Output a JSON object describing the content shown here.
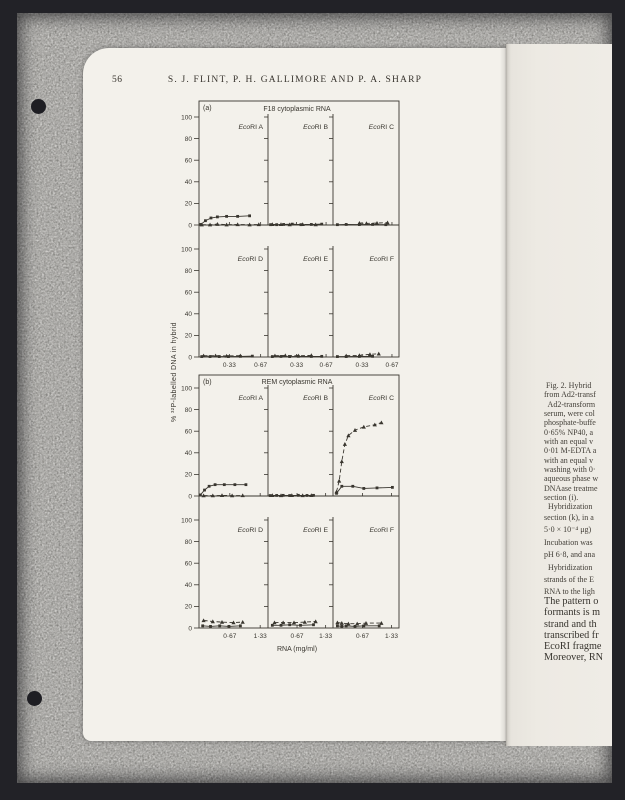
{
  "page": {
    "number": "56",
    "running_header": "S. J. FLINT, P. H. GALLIMORE AND P. A. SHARP"
  },
  "chart_data": {
    "type": "line",
    "ylabel": "% ³²P-labelled DNA in hybrid",
    "xlabel": "RNA (mg/ml)",
    "ylim": [
      0,
      100
    ],
    "y_ticks": [
      0,
      20,
      40,
      60,
      80,
      100
    ],
    "panels": [
      {
        "label": "(a)",
        "title": "F18 cytoplasmic RNA",
        "x_max": 0.75,
        "x_tick_values": [
          0.33,
          0.67
        ],
        "x_tick_labels": [
          "0·33",
          "0·67"
        ],
        "subpanels": [
          {
            "name": "EcoRI A",
            "solid": [
              [
                0.02,
                0.5
              ],
              [
                0.07,
                4
              ],
              [
                0.13,
                6.5
              ],
              [
                0.2,
                7.5
              ],
              [
                0.3,
                8
              ],
              [
                0.42,
                8
              ],
              [
                0.55,
                8.5
              ]
            ],
            "dashed": [
              [
                0.03,
                0.3
              ],
              [
                0.12,
                0.3
              ],
              [
                0.2,
                0.8
              ],
              [
                0.3,
                0.3
              ],
              [
                0.42,
                0.5
              ],
              [
                0.55,
                0.3
              ],
              [
                0.65,
                0.5
              ]
            ]
          },
          {
            "name": "EcoRI B",
            "solid": [
              [
                0.03,
                0.3
              ],
              [
                0.1,
                0.3
              ],
              [
                0.18,
                0.5
              ],
              [
                0.28,
                0.8
              ],
              [
                0.38,
                0.3
              ],
              [
                0.5,
                0.5
              ],
              [
                0.62,
                0.8
              ]
            ],
            "dashed": [
              [
                0.05,
                0.6
              ],
              [
                0.15,
                0.6
              ],
              [
                0.25,
                0.4
              ],
              [
                0.4,
                0.6
              ],
              [
                0.55,
                0.4
              ]
            ]
          },
          {
            "name": "EcoRI C",
            "solid": [
              [
                0.05,
                0.3
              ],
              [
                0.15,
                0.5
              ],
              [
                0.3,
                0.4
              ],
              [
                0.45,
                0.5
              ],
              [
                0.6,
                0.3
              ]
            ],
            "dashed": [
              [
                0.3,
                1.8
              ],
              [
                0.38,
                1.5
              ],
              [
                0.5,
                1.8
              ],
              [
                0.62,
                2.2
              ]
            ]
          },
          {
            "name": "EcoRI D",
            "solid": [
              [
                0.03,
                0.4
              ],
              [
                0.12,
                0.4
              ],
              [
                0.22,
                0.4
              ],
              [
                0.32,
                0.4
              ],
              [
                0.45,
                0.6
              ],
              [
                0.58,
                0.8
              ]
            ],
            "dashed": [
              [
                0.05,
                1.2
              ],
              [
                0.18,
                1.2
              ],
              [
                0.3,
                1.0
              ],
              [
                0.45,
                1.2
              ]
            ]
          },
          {
            "name": "EcoRI E",
            "solid": [
              [
                0.05,
                0.4
              ],
              [
                0.15,
                0.5
              ],
              [
                0.25,
                0.4
              ],
              [
                0.35,
                0.6
              ],
              [
                0.5,
                0.5
              ],
              [
                0.62,
                0.6
              ]
            ],
            "dashed": [
              [
                0.08,
                1.2
              ],
              [
                0.2,
                1.4
              ],
              [
                0.35,
                1.2
              ],
              [
                0.5,
                1.5
              ]
            ]
          },
          {
            "name": "EcoRI F",
            "solid": [
              [
                0.05,
                0.4
              ],
              [
                0.15,
                0.4
              ],
              [
                0.3,
                0.5
              ],
              [
                0.45,
                0.6
              ]
            ],
            "dashed": [
              [
                0.15,
                1.2
              ],
              [
                0.3,
                1.5
              ],
              [
                0.42,
                2.5
              ],
              [
                0.52,
                3.0
              ]
            ]
          }
        ]
      },
      {
        "label": "(b)",
        "title": "REM cytoplasmic RNA",
        "x_max": 1.5,
        "x_tick_values": [
          0.67,
          1.33
        ],
        "x_tick_labels": [
          "0·67",
          "1·33"
        ],
        "subpanels": [
          {
            "name": "EcoRI A",
            "solid": [
              [
                0.03,
                1
              ],
              [
                0.12,
                5.5
              ],
              [
                0.22,
                9
              ],
              [
                0.35,
                10.5
              ],
              [
                0.55,
                10.5
              ],
              [
                0.78,
                10.5
              ],
              [
                1.02,
                10.5
              ]
            ],
            "dashed": [
              [
                0.1,
                0.4
              ],
              [
                0.3,
                0.4
              ],
              [
                0.5,
                0.6
              ],
              [
                0.72,
                0.4
              ],
              [
                0.95,
                0.5
              ]
            ]
          },
          {
            "name": "EcoRI B",
            "solid": [
              [
                0.05,
                0.4
              ],
              [
                0.2,
                0.5
              ],
              [
                0.35,
                0.6
              ],
              [
                0.5,
                0.4
              ],
              [
                0.7,
                0.6
              ],
              [
                0.9,
                0.5
              ],
              [
                1.05,
                0.6
              ]
            ],
            "dashed": [
              [
                0.1,
                0.6
              ],
              [
                0.3,
                0.5
              ],
              [
                0.55,
                0.6
              ],
              [
                0.8,
                0.5
              ],
              [
                1.0,
                0.6
              ]
            ]
          },
          {
            "name": "EcoRI C",
            "solid": [
              [
                0.08,
                2.5
              ],
              [
                0.2,
                9
              ],
              [
                0.45,
                9
              ],
              [
                0.7,
                7
              ],
              [
                1.0,
                7.5
              ],
              [
                1.35,
                8
              ]
            ],
            "dashed": [
              [
                0.08,
                4
              ],
              [
                0.14,
                14
              ],
              [
                0.2,
                32
              ],
              [
                0.27,
                48
              ],
              [
                0.35,
                56
              ],
              [
                0.5,
                61
              ],
              [
                0.7,
                64
              ],
              [
                0.95,
                66
              ],
              [
                1.1,
                68
              ]
            ]
          },
          {
            "name": "EcoRI D",
            "solid": [
              [
                0.08,
                2
              ],
              [
                0.25,
                1.5
              ],
              [
                0.45,
                2
              ],
              [
                0.65,
                1.5
              ],
              [
                0.9,
                2
              ]
            ],
            "dashed": [
              [
                0.1,
                7
              ],
              [
                0.3,
                6
              ],
              [
                0.5,
                5.5
              ],
              [
                0.75,
                5
              ],
              [
                0.95,
                5.5
              ]
            ]
          },
          {
            "name": "EcoRI E",
            "solid": [
              [
                0.1,
                2.5
              ],
              [
                0.3,
                2.5
              ],
              [
                0.5,
                3
              ],
              [
                0.75,
                2.5
              ],
              [
                1.05,
                3
              ]
            ],
            "dashed": [
              [
                0.15,
                5
              ],
              [
                0.35,
                5
              ],
              [
                0.6,
                5
              ],
              [
                0.85,
                5.5
              ],
              [
                1.1,
                6
              ]
            ]
          },
          {
            "name": "EcoRI F",
            "solid": [
              [
                0.1,
                2
              ],
              [
                0.2,
                1.5
              ],
              [
                0.3,
                2
              ],
              [
                0.5,
                1.5
              ],
              [
                0.7,
                2
              ],
              [
                1.05,
                2
              ]
            ],
            "dashed": [
              [
                0.1,
                5
              ],
              [
                0.2,
                4.5
              ],
              [
                0.35,
                4
              ],
              [
                0.55,
                4
              ],
              [
                0.75,
                4.5
              ],
              [
                1.1,
                4.5
              ]
            ]
          }
        ]
      }
    ]
  },
  "caption": {
    "part1": [
      " Fig. 2. Hybrid",
      "from Ad2-transf",
      "  Ad2-transform",
      "serum, were col",
      "phosphate-buffe",
      "0·65% NP40, a",
      "with an equal v",
      "0·01 M-EDTA a",
      "with an equal v",
      "washing with 0·",
      "aqueous phase w",
      "DNAase treatme",
      "section (i).",
      "  Hybridization"
    ],
    "part2": [
      "section (k), in a",
      "5·0 × 10⁻⁴ μg)",
      "Incubation was",
      "pH 6·8, and ana",
      "  Hybridization",
      "strands of the E",
      "RNA to the ligh"
    ]
  },
  "body_text": {
    "lines": [
      "The pattern o",
      "formants is m",
      "strand and th",
      "transcribed fr",
      "EcoRI fragme",
      "Moreover, RN"
    ]
  }
}
